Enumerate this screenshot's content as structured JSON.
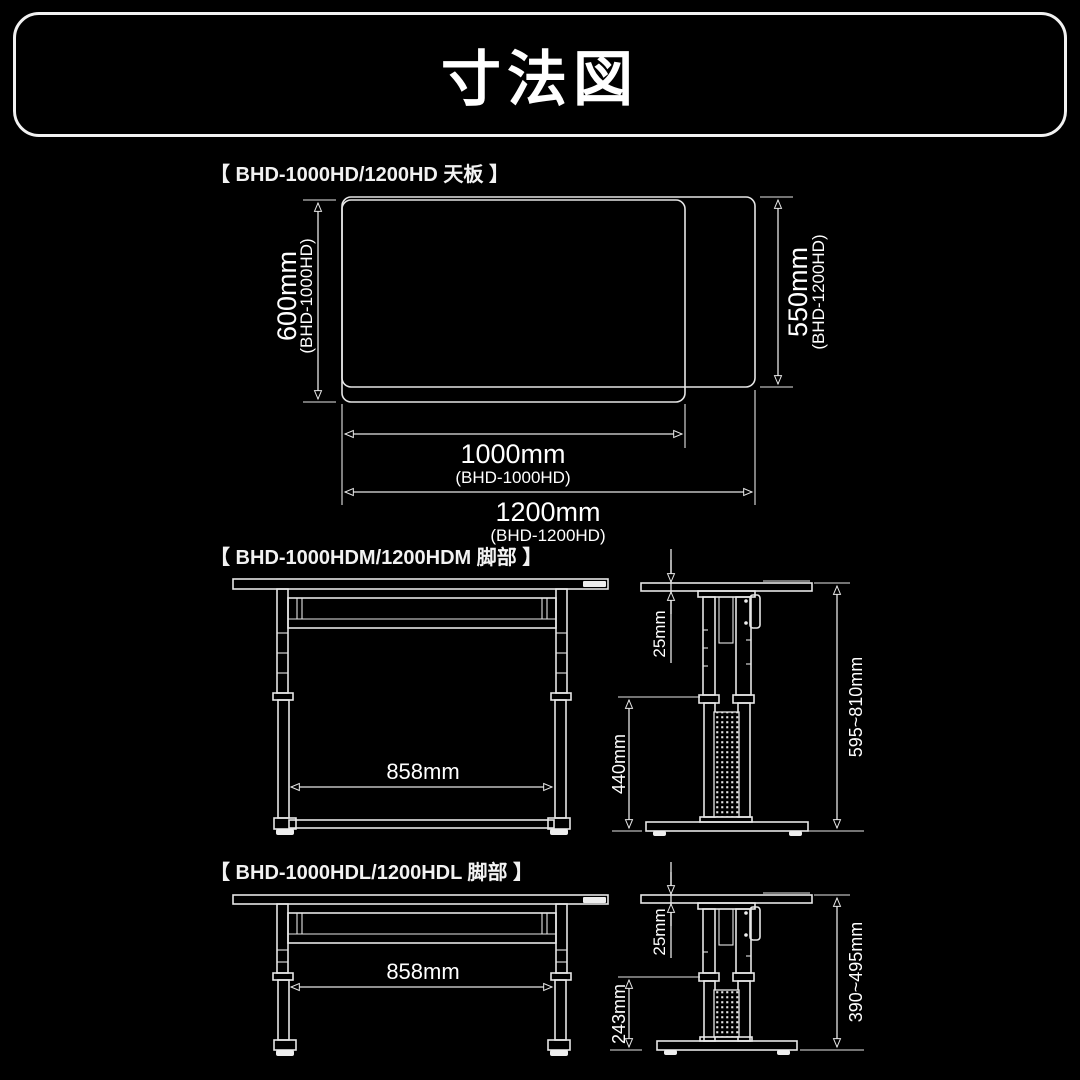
{
  "page": {
    "background_color": "#000000",
    "line_color": "#e6e6e6",
    "text_color": "#ffffff"
  },
  "header": {
    "title": "寸法図"
  },
  "sections": [
    {
      "title": "【 BHD-1000HD/1200HD 天板 】",
      "dims": {
        "depth_a": {
          "value": "600mm",
          "model": "(BHD-1000HD)"
        },
        "depth_b": {
          "value": "550mm",
          "model": "(BHD-1200HD)"
        },
        "width_a": {
          "value": "1000mm",
          "model": "(BHD-1000HD)"
        },
        "width_b": {
          "value": "1200mm",
          "model": "(BHD-1200HD)"
        }
      }
    },
    {
      "title": "【 BHD-1000HDM/1200HDM 脚部 】",
      "dims": {
        "inner_width": "858mm",
        "top_thickness": "25mm",
        "column_height": "440mm",
        "height_range": "595~810mm"
      }
    },
    {
      "title": "【 BHD-1000HDL/1200HDL 脚部 】",
      "dims": {
        "inner_width": "858mm",
        "top_thickness": "25mm",
        "column_height": "243mm",
        "height_range": "390~495mm"
      }
    }
  ]
}
